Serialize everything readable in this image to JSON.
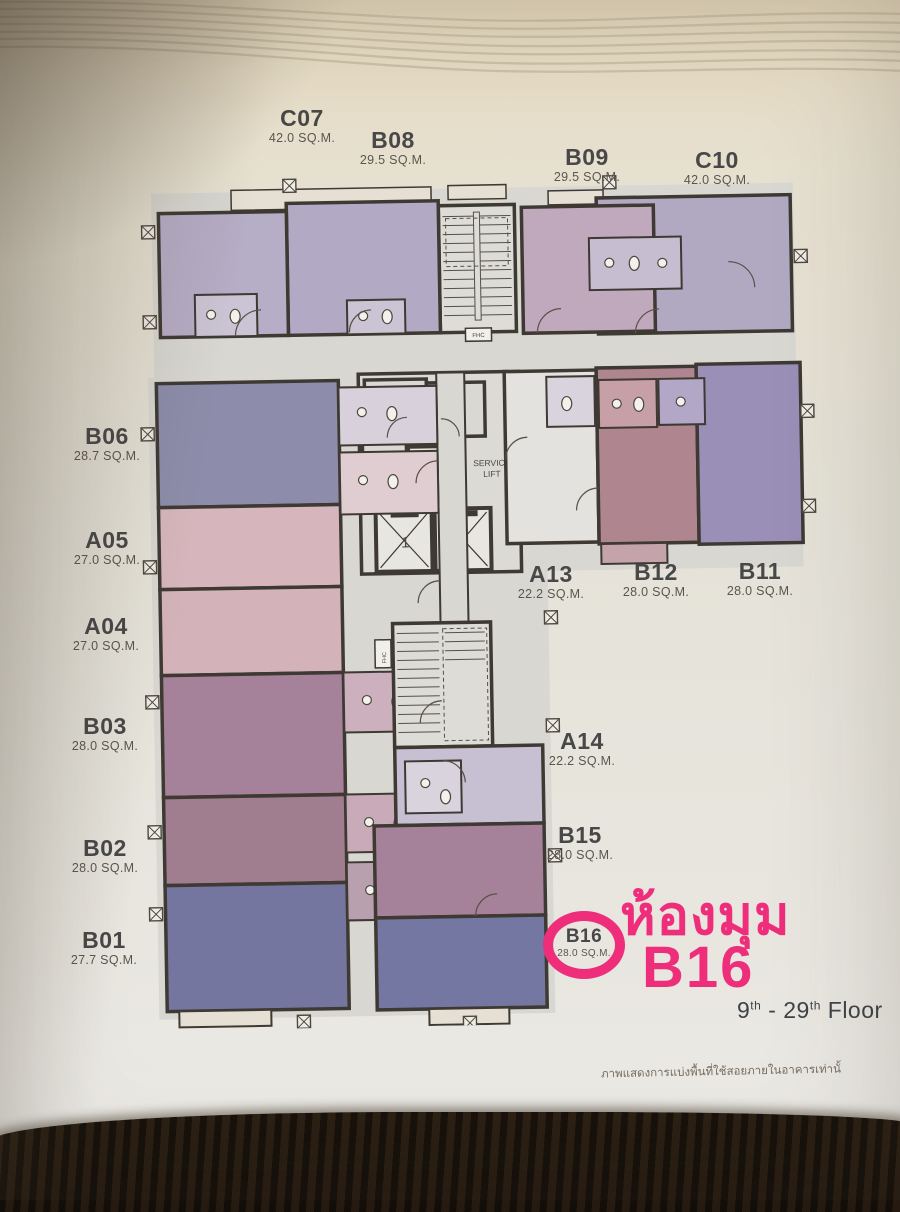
{
  "photo": {
    "caption": "ภาพแสดงการแบ่งพื้นที่ใช้สอยภายในอาคารเท่านั้"
  },
  "plan": {
    "units": [
      {
        "name": "C07",
        "area": "42.0 SQ.M.",
        "color": "#b6adc6"
      },
      {
        "name": "B08",
        "area": "29.5 SQ.M.",
        "color": "#b2a9c4"
      },
      {
        "name": "B09",
        "area": "29.5 SQ.M.",
        "color": "#c0a9bd"
      },
      {
        "name": "C10",
        "area": "42.0 SQ.M.",
        "color": "#b1a8c2"
      },
      {
        "name": "B06",
        "area": "28.7 SQ.M.",
        "color": "#8d8dab"
      },
      {
        "name": "A05",
        "area": "27.0 SQ.M.",
        "color": "#d6b6bc"
      },
      {
        "name": "A04",
        "area": "27.0 SQ.M.",
        "color": "#d3b3b9"
      },
      {
        "name": "B03",
        "area": "28.0 SQ.M.",
        "color": "#a6829a"
      },
      {
        "name": "B02",
        "area": "28.0 SQ.M.",
        "color": "#a17e8f"
      },
      {
        "name": "B01",
        "area": "27.7 SQ.M.",
        "color": "#7476a0"
      },
      {
        "name": "A13",
        "area": "22.2 SQ.M.",
        "color": "#e4e2de"
      },
      {
        "name": "B12",
        "area": "28.0 SQ.M.",
        "color": "#af8590"
      },
      {
        "name": "B11",
        "area": "28.0 SQ.M.",
        "color": "#9a8fb7"
      },
      {
        "name": "A14",
        "area": "22.2 SQ.M.",
        "color": "#c7c0d3"
      },
      {
        "name": "B15",
        "area": "28.0 SQ.M.",
        "color": "#a6829a"
      },
      {
        "name": "B16",
        "area": "28.0 SQ.M.",
        "color": "#7477a1"
      }
    ],
    "core": {
      "ee": "EE.",
      "gb": "GB.",
      "sn": "SN.",
      "service_line1": "SERVICE",
      "service_line2": "LIFT",
      "lift1": "1",
      "lift2": "2",
      "fhc": "FHC"
    }
  },
  "annotation": {
    "thai_title": "ห้องมุม",
    "unit": "B16",
    "accent_color": "#ee2d7b",
    "floor": {
      "from": "9",
      "sup": "th",
      "dash": " - ",
      "to": "29",
      "word": "Floor"
    }
  }
}
